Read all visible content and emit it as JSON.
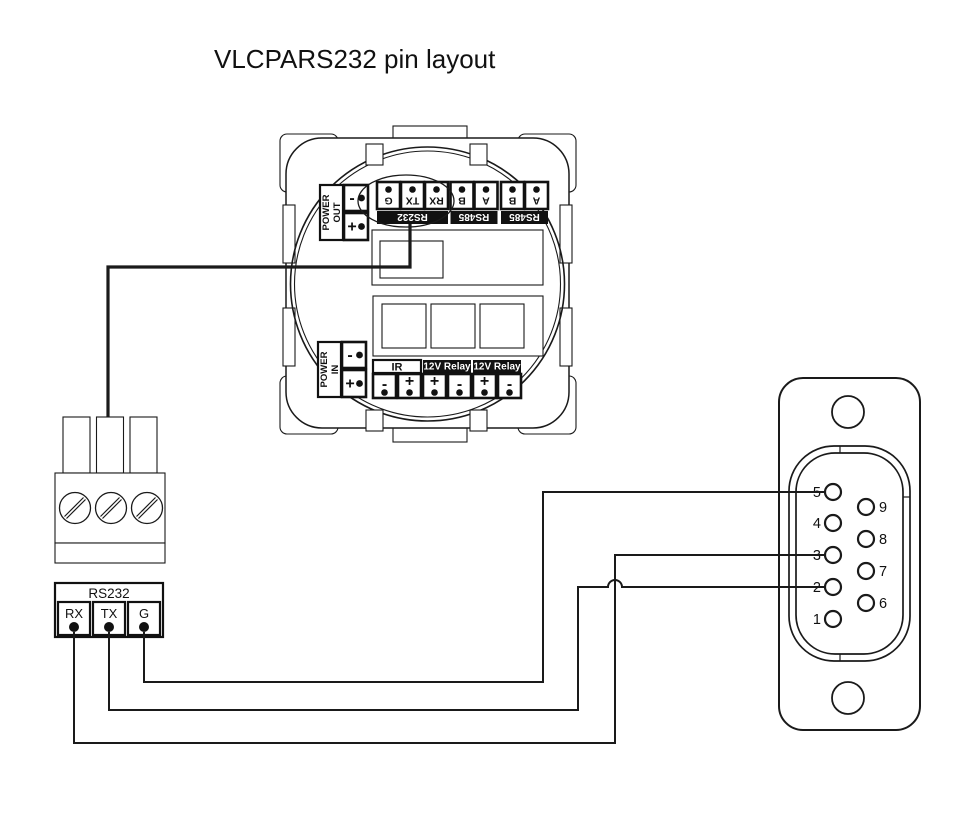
{
  "title": "VLCPARS232 pin layout",
  "device": {
    "power_out": {
      "line1": "POWER",
      "line2": "OUT",
      "neg": "-",
      "pos": "+"
    },
    "power_in": {
      "line1": "POWER",
      "line2": "IN",
      "neg": "-",
      "pos": "+"
    },
    "top_groups": [
      {
        "label": "RS232",
        "pins": [
          "G",
          "TX",
          "RX"
        ]
      },
      {
        "label": "RS485",
        "pins": [
          "B",
          "A"
        ]
      },
      {
        "label": "RS485",
        "pins": [
          "B",
          "A"
        ]
      }
    ],
    "bottom_groups": [
      {
        "label": "IR",
        "pins": [
          "-",
          "+"
        ]
      },
      {
        "label": "12V Relay",
        "pins": [
          "+",
          "-"
        ]
      },
      {
        "label": "12V Relay",
        "pins": [
          "+",
          "-"
        ]
      }
    ]
  },
  "breakout": {
    "header": "RS232",
    "pins": [
      "RX",
      "TX",
      "G"
    ]
  },
  "db9": {
    "left_pins": [
      "5",
      "4",
      "3",
      "2",
      "1"
    ],
    "right_pins": [
      "9",
      "8",
      "7",
      "6"
    ]
  },
  "connections": [
    {
      "from": "G",
      "to": "5"
    },
    {
      "from": "TX",
      "to": "2"
    },
    {
      "from": "RX",
      "to": "3"
    }
  ],
  "colors": {
    "ink": "#111111",
    "paper": "#ffffff"
  }
}
